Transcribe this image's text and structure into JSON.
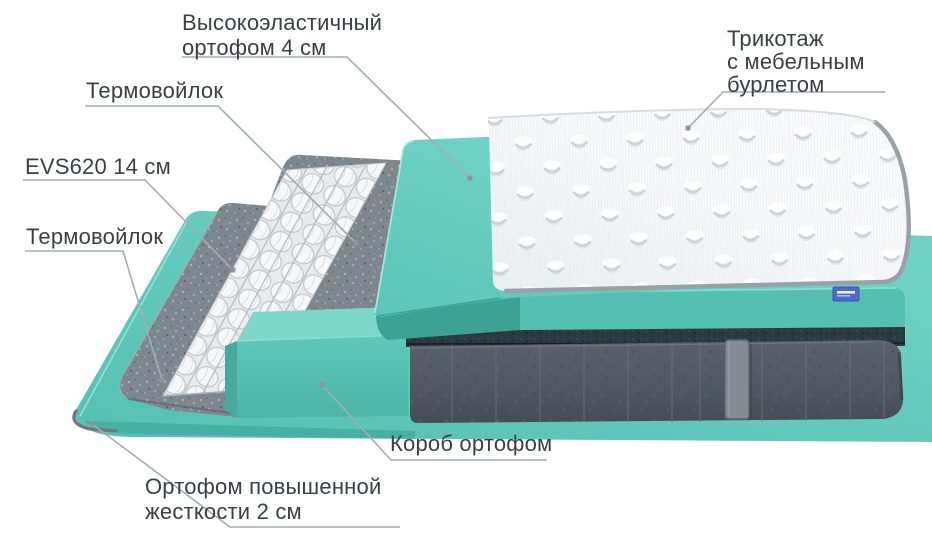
{
  "diagram": {
    "background": "#ffffff",
    "subject": "mattress-layers-exploded-view",
    "labels": {
      "top_foam": {
        "line1": "Высокоэластичный",
        "line2": "ортофом 4 см"
      },
      "knit_cover": {
        "line1": "Трикотаж",
        "line2": "с мебельным",
        "line3": "бурлетом"
      },
      "thermofelt_upper": {
        "text": "Термовойлок"
      },
      "springs": {
        "text": "EVS620 14 см"
      },
      "thermofelt_lower": {
        "text": "Термовойлок"
      },
      "foam_box": {
        "text": "Короб ортофом"
      },
      "base_foam": {
        "line1": "Ортофом повышенной",
        "line2": "жесткости 2 см"
      }
    },
    "colors": {
      "teal_sheet": "#5dc6b9",
      "teal_slab": "#68cfc1",
      "teal_dark_edge": "#3da294",
      "box_teal": "#58c2b4",
      "felt_gray": "#7d868c",
      "spring_white": "#f5f7f8",
      "velvet_gray": "#525a60",
      "piping_dark": "#2b3a3f",
      "cover_white": "#f6f8f9",
      "leader_line_gray": "#a6acb0",
      "text_color": "#3a4045",
      "brand_tag_blue": "#4f68cc"
    }
  }
}
